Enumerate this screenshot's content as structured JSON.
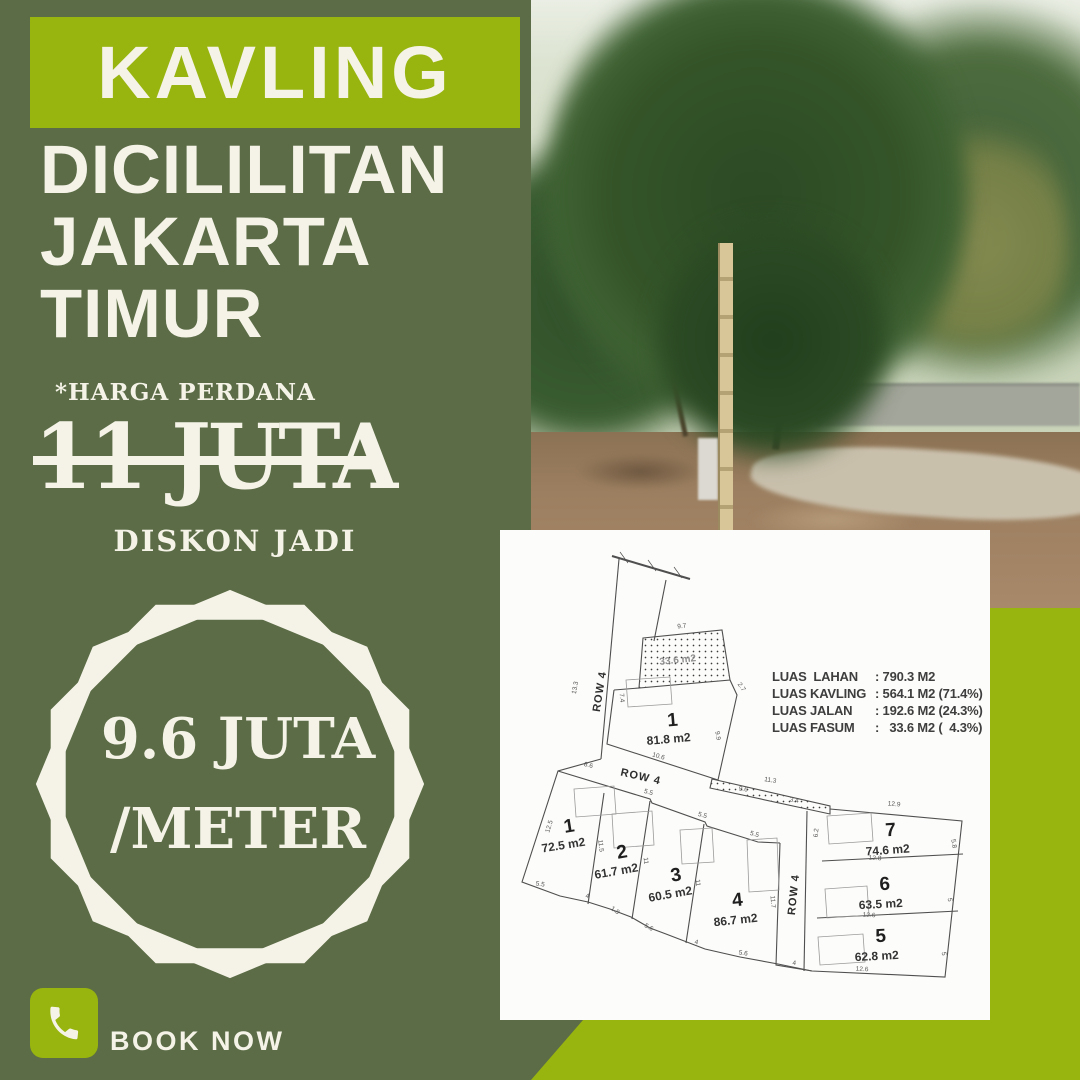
{
  "colors": {
    "olive": "#5b6c46",
    "green": "#98b50f",
    "cream": "#f5f3e8",
    "plan_line": "#4f4f4f"
  },
  "left_panel": {
    "headline": "KAVLING",
    "location": [
      "DICILILITAN",
      "JAKARTA",
      "TIMUR"
    ],
    "price_note": "*HARGA PERDANA",
    "old_price": "11 JUTA",
    "discount_label": "DISKON JADI",
    "badge": {
      "line1": "9.6 JUTA",
      "line2": "/METER"
    },
    "cta": {
      "label": "BOOK NOW",
      "icon": "phone-icon"
    }
  },
  "siteplan": {
    "legend": [
      {
        "label": "LUAS  LAHAN",
        "value": ": 790.3 M2"
      },
      {
        "label": "LUAS KAVLING",
        "value": ": 564.1 M2 (71.4%)"
      },
      {
        "label": "LUAS JALAN",
        "value": ": 192.6 M2 (24.3%)"
      },
      {
        "label": "LUAS FASUM",
        "value": ":   33.6 M2 (  4.3%)"
      }
    ],
    "fasum_label": {
      "t": "33.6 m2",
      "x": 178,
      "y": 133,
      "r": -6
    },
    "row_labels": [
      {
        "t": "ROW 4",
        "x": 103,
        "y": 162,
        "r": -81
      },
      {
        "t": "ROW 4",
        "x": 140,
        "y": 250,
        "r": 13
      },
      {
        "t": "ROW 4",
        "x": 297,
        "y": 365,
        "r": -84
      }
    ],
    "plots": [
      {
        "num": "1",
        "area": "81.8 m2",
        "nx": 173,
        "ny": 196,
        "ax": 169,
        "ay": 213,
        "r": -5
      },
      {
        "num": "1",
        "area": "72.5 m2",
        "nx": 70,
        "ny": 302,
        "ax": 64,
        "ay": 319,
        "r": -9
      },
      {
        "num": "2",
        "area": "61.7 m2",
        "nx": 123,
        "ny": 328,
        "ax": 117,
        "ay": 345,
        "r": -10
      },
      {
        "num": "3",
        "area": "60.5 m2",
        "nx": 177,
        "ny": 351,
        "ax": 171,
        "ay": 368,
        "r": -10
      },
      {
        "num": "4",
        "area": "86.7 m2",
        "nx": 238,
        "ny": 376,
        "ax": 236,
        "ay": 394,
        "r": -6
      },
      {
        "num": "7",
        "area": "74.6 m2",
        "nx": 391,
        "ny": 306,
        "ax": 388,
        "ay": 324,
        "r": -4
      },
      {
        "num": "6",
        "area": "63.5 m2",
        "nx": 385,
        "ny": 360,
        "ax": 381,
        "ay": 378,
        "r": -3
      },
      {
        "num": "5",
        "area": "62.8 m2",
        "nx": 381,
        "ny": 412,
        "ax": 377,
        "ay": 430,
        "r": -3
      }
    ],
    "dims": [
      {
        "t": "9.7",
        "x": 182,
        "y": 98,
        "r": -6
      },
      {
        "t": "2.7",
        "x": 240,
        "y": 158,
        "r": 55
      },
      {
        "t": "7.4",
        "x": 120,
        "y": 168,
        "r": 85
      },
      {
        "t": "9.9",
        "x": 216,
        "y": 206,
        "r": 80
      },
      {
        "t": "10.6",
        "x": 158,
        "y": 228,
        "r": 16
      },
      {
        "t": "13.3",
        "x": 77,
        "y": 158,
        "r": -80
      },
      {
        "t": "8.6",
        "x": 88,
        "y": 237,
        "r": 14
      },
      {
        "t": "5.5",
        "x": 148,
        "y": 264,
        "r": 16
      },
      {
        "t": "5.5",
        "x": 202,
        "y": 287,
        "r": 16
      },
      {
        "t": "5.5",
        "x": 254,
        "y": 306,
        "r": 16
      },
      {
        "t": "12.5",
        "x": 51,
        "y": 297,
        "r": -73
      },
      {
        "t": "11.5",
        "x": 99,
        "y": 316,
        "r": 83
      },
      {
        "t": "11",
        "x": 144,
        "y": 331,
        "r": 83
      },
      {
        "t": "11",
        "x": 196,
        "y": 353,
        "r": 83
      },
      {
        "t": "11.7",
        "x": 271,
        "y": 372,
        "r": 85
      },
      {
        "t": "5.5",
        "x": 40,
        "y": 356,
        "r": 8
      },
      {
        "t": "4",
        "x": 87,
        "y": 368,
        "r": 10
      },
      {
        "t": "1.8",
        "x": 114,
        "y": 382,
        "r": 35
      },
      {
        "t": "5.6",
        "x": 148,
        "y": 399,
        "r": 28
      },
      {
        "t": "4",
        "x": 196,
        "y": 414,
        "r": 12
      },
      {
        "t": "5.6",
        "x": 243,
        "y": 425,
        "r": 8
      },
      {
        "t": "4",
        "x": 294,
        "y": 435,
        "r": 6
      },
      {
        "t": "11.3",
        "x": 270,
        "y": 252,
        "r": 10
      },
      {
        "t": "9.6",
        "x": 243,
        "y": 261,
        "r": 10
      },
      {
        "t": "3.4",
        "x": 294,
        "y": 272,
        "r": 10
      },
      {
        "t": "12.9",
        "x": 394,
        "y": 276,
        "r": 4
      },
      {
        "t": "6.2",
        "x": 318,
        "y": 303,
        "r": -85
      },
      {
        "t": "12.8",
        "x": 375,
        "y": 330,
        "r": 3
      },
      {
        "t": "12.6",
        "x": 369,
        "y": 387,
        "r": 3
      },
      {
        "t": "12.6",
        "x": 362,
        "y": 441,
        "r": 3
      },
      {
        "t": "5.8",
        "x": 452,
        "y": 314,
        "r": 80
      },
      {
        "t": "5",
        "x": 448,
        "y": 370,
        "r": 80
      },
      {
        "t": "5",
        "x": 442,
        "y": 424,
        "r": 80
      }
    ]
  }
}
